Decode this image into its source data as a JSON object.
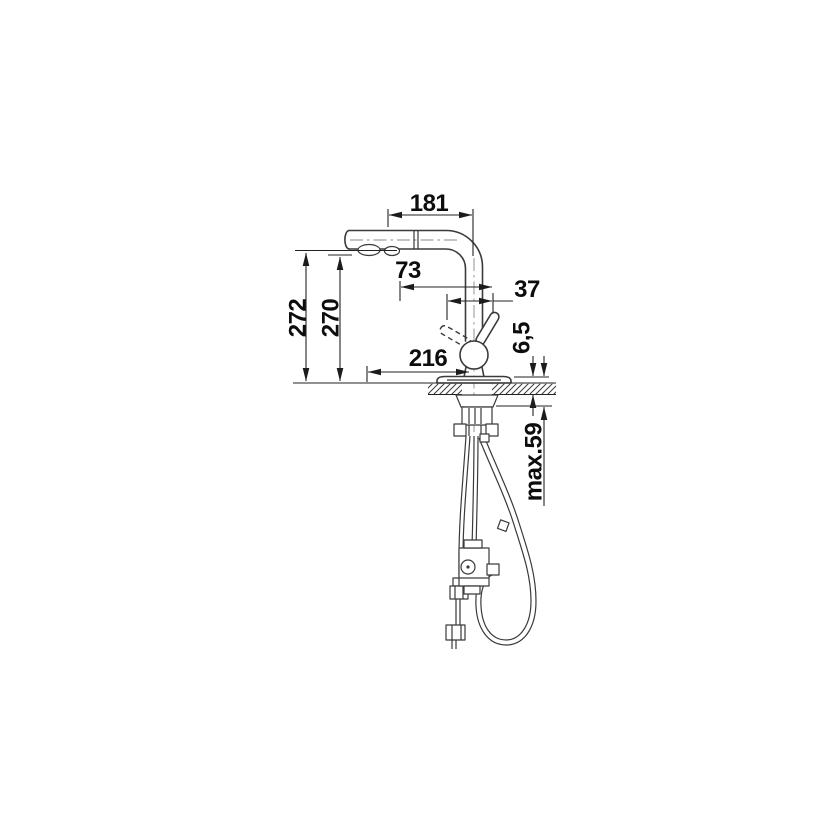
{
  "drawing": {
    "subject": "pull-out kitchen faucet dimensional drawing",
    "background": "#ffffff",
    "line_color": "#3a3a3a",
    "dimension_color": "#222222",
    "text_color": "#0d0d0d",
    "labels": {
      "spout_reach": "181",
      "outlet_offset": "73",
      "handle_offset": "37",
      "height_total": "272",
      "height_outlet": "270",
      "base_reach": "216",
      "base_plate_height": "6,5",
      "max_deck_thickness": "max.59"
    }
  }
}
